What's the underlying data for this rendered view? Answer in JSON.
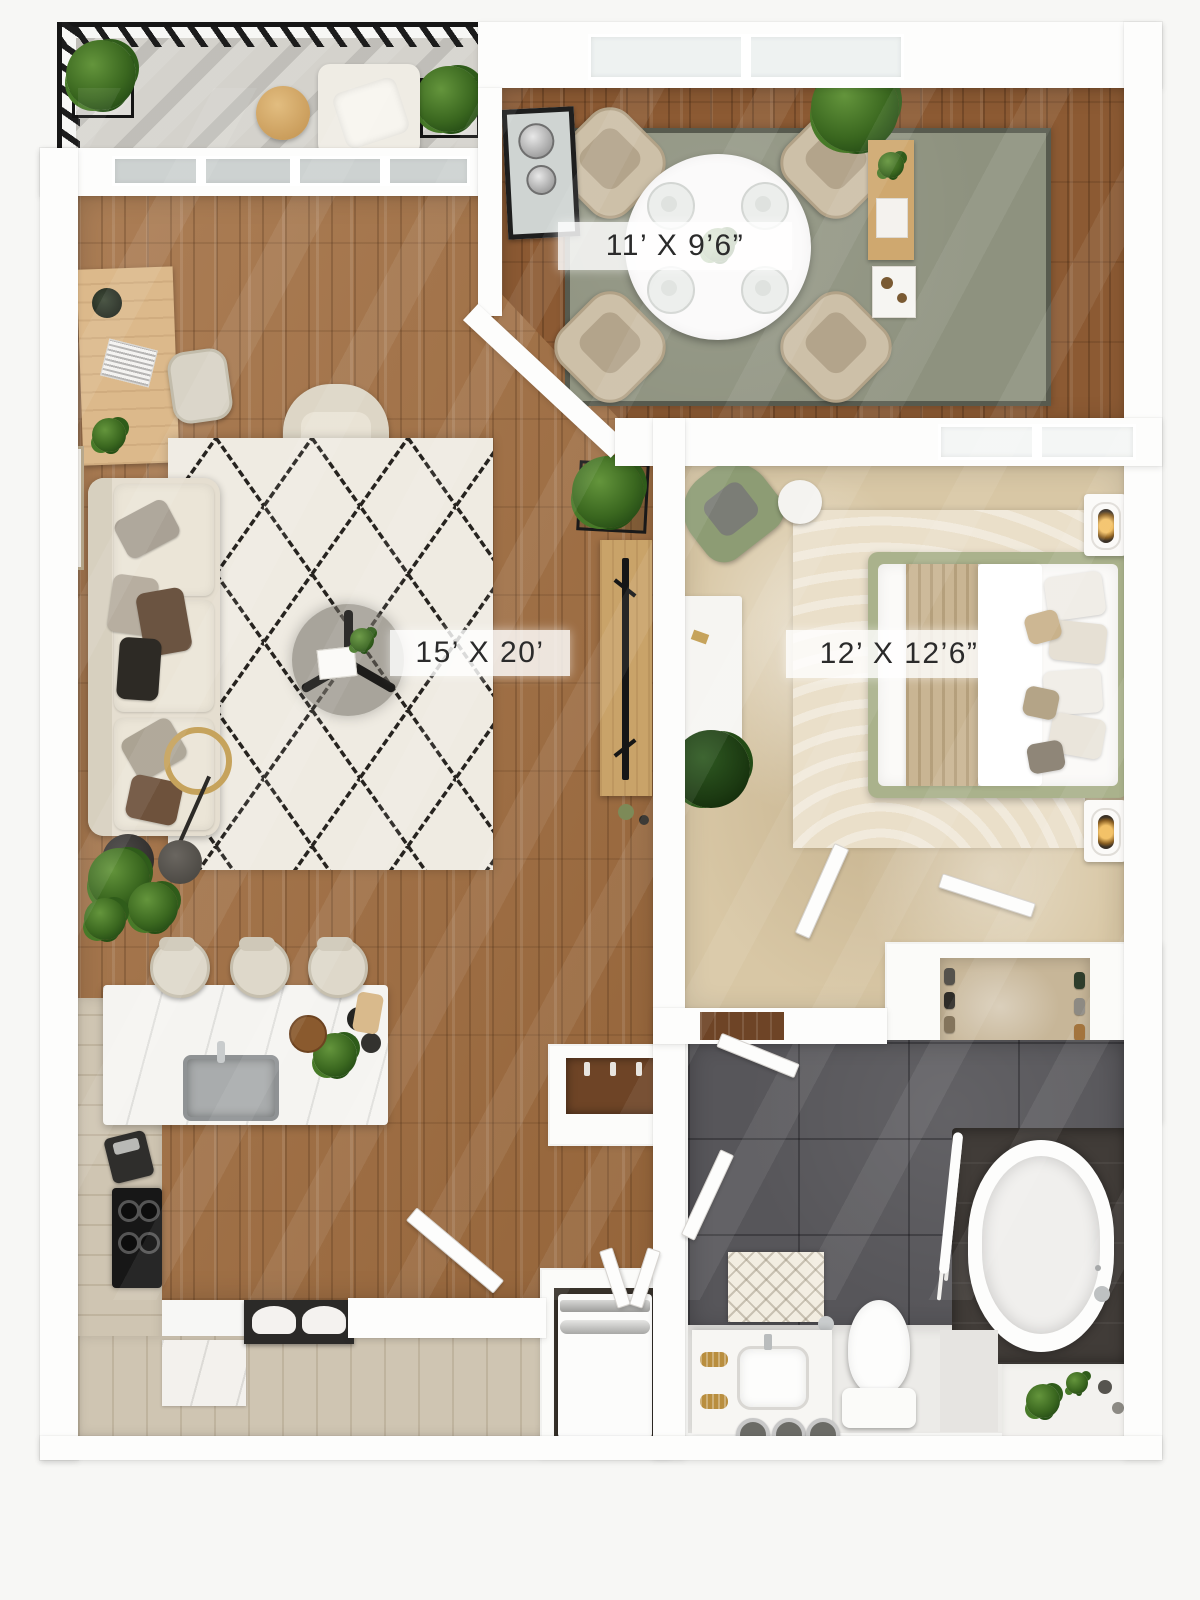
{
  "rooms": {
    "dining": {
      "label": "11’ X 9’6”"
    },
    "living": {
      "label": "15’ X 20’"
    },
    "bedroom": {
      "label": "12’ X 12’6”"
    }
  },
  "palette": {
    "wood_floor": "#a06c3e",
    "wood_floor_dining": "#8c5a33",
    "bedroom_carpet": "#d8c7a5",
    "bath_tile": "#57565a",
    "living_rug": "#efebe2",
    "dining_rug": "#8e927f",
    "wall": "#fdfdfc",
    "sofa": "#e5ded0",
    "bed_frame_green": "#aab28c",
    "armchair_green": "#8d9c74",
    "gold_accent": "#c6a35c",
    "plant_green": "#3a671f",
    "railing_black": "#1c1c1c"
  }
}
